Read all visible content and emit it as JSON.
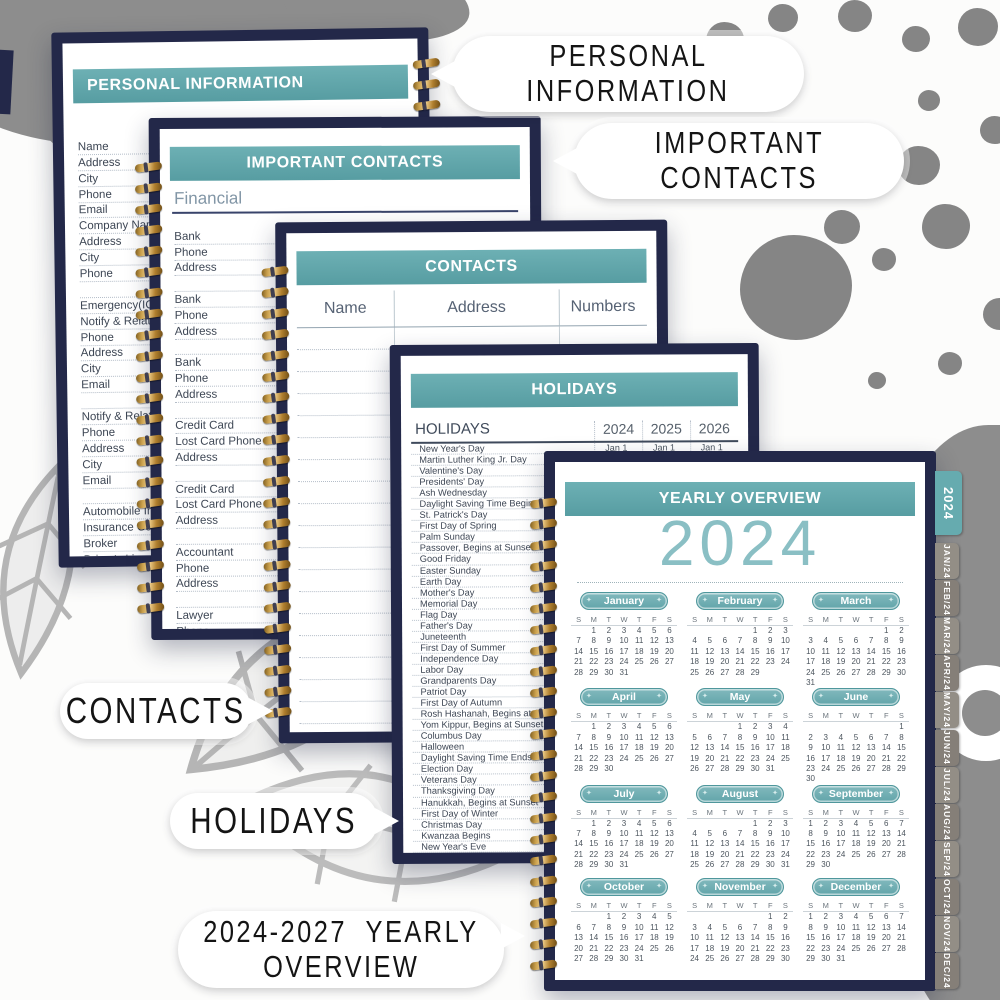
{
  "callouts": {
    "personal_info": {
      "line1": "PERSONAL",
      "line2": "INFORMATION"
    },
    "important_contacts": {
      "line1": "IMPORTANT",
      "line2": "CONTACTS"
    },
    "contacts": {
      "line1": "CONTACTS",
      "line2": ""
    },
    "holidays": {
      "line1": "HOLIDAYS",
      "line2": ""
    },
    "yearly": {
      "line1": "2024-2027  YEARLY",
      "line2": "OVERVIEW"
    }
  },
  "pages": {
    "personal_info": {
      "title": "PERSONAL INFORMATION",
      "rows": [
        "Name",
        "Address",
        "City",
        "Phone",
        "Email",
        "Company Name",
        "Address",
        "City",
        "Phone",
        "",
        "Emergency(ICE)",
        "Notify & Relationship",
        "Phone",
        "Address",
        "City",
        "Email",
        "",
        "Notify & Relationship",
        "Phone",
        "Address",
        "City",
        "Email",
        "",
        "Automobile Information",
        "Insurance Co.",
        "Broker",
        "Driver's License #",
        "Plate #",
        "",
        ""
      ]
    },
    "important_contacts": {
      "title": "IMPORTANT CONTACTS",
      "section": "Financial",
      "rows": [
        "Bank",
        "Phone",
        "Address",
        "",
        "Bank",
        "Phone",
        "Address",
        "",
        "Bank",
        "Phone",
        "Address",
        "",
        "Credit Card",
        "Lost Card Phone",
        "Address",
        "",
        "Credit Card",
        "Lost Card Phone",
        "Address",
        "",
        "Accountant",
        "Phone",
        "Address",
        "",
        "Lawyer",
        "Phone",
        "Address",
        ""
      ],
      "right_labels": [
        "Contact",
        "Email"
      ]
    },
    "contacts": {
      "title": "CONTACTS",
      "columns": [
        "Name",
        "Address",
        "Numbers"
      ],
      "blank_row_count": 18
    },
    "holidays": {
      "title": "HOLIDAYS",
      "header_col": "HOLIDAYS",
      "year_cols": [
        "2024",
        "2025",
        "2026"
      ],
      "rows": [
        {
          "name": "New Year's Day",
          "dates": [
            "Jan 1",
            "Jan 1",
            "Jan 1"
          ]
        },
        {
          "name": "Martin Luther King Jr. Day",
          "dates": [
            "Jan 15",
            "Jan 20",
            "Jan 19"
          ]
        },
        {
          "name": "Valentine's Day",
          "dates": [
            "Feb 14",
            "Feb14",
            "Feb14"
          ]
        },
        {
          "name": "Presidents' Day",
          "dates": [
            "",
            "",
            ""
          ]
        },
        {
          "name": "Ash Wednesday",
          "dates": [
            "",
            "",
            ""
          ]
        },
        {
          "name": "Daylight Saving Time Begins",
          "dates": [
            "",
            "",
            ""
          ]
        },
        {
          "name": "St. Patrick's Day",
          "dates": [
            "",
            "",
            ""
          ]
        },
        {
          "name": "First Day of Spring",
          "dates": [
            "",
            "",
            ""
          ]
        },
        {
          "name": "Palm Sunday",
          "dates": [
            "",
            "",
            ""
          ]
        },
        {
          "name": "Passover, Begins at Sunset",
          "dates": [
            "",
            "",
            ""
          ]
        },
        {
          "name": "Good Friday",
          "dates": [
            "",
            "",
            ""
          ]
        },
        {
          "name": "Easter Sunday",
          "dates": [
            "",
            "",
            ""
          ]
        },
        {
          "name": "Earth Day",
          "dates": [
            "",
            "",
            ""
          ]
        },
        {
          "name": "Mother's Day",
          "dates": [
            "",
            "",
            ""
          ]
        },
        {
          "name": "Memorial Day",
          "dates": [
            "",
            "",
            ""
          ]
        },
        {
          "name": "Flag Day",
          "dates": [
            "",
            "",
            ""
          ]
        },
        {
          "name": "Father's Day",
          "dates": [
            "",
            "",
            ""
          ]
        },
        {
          "name": "Juneteenth",
          "dates": [
            "",
            "",
            ""
          ]
        },
        {
          "name": "First Day of Summer",
          "dates": [
            "",
            "",
            ""
          ]
        },
        {
          "name": "Independence Day",
          "dates": [
            "",
            "",
            ""
          ]
        },
        {
          "name": "Labor Day",
          "dates": [
            "",
            "",
            ""
          ]
        },
        {
          "name": "Grandparents Day",
          "dates": [
            "",
            "",
            ""
          ]
        },
        {
          "name": "Patriot Day",
          "dates": [
            "",
            "",
            ""
          ]
        },
        {
          "name": "First Day of Autumn",
          "dates": [
            "",
            "",
            ""
          ]
        },
        {
          "name": "Rosh Hashanah, Begins at Sunset",
          "dates": [
            "",
            "",
            ""
          ]
        },
        {
          "name": "Yom Kippur, Begins at Sunset",
          "dates": [
            "",
            "",
            ""
          ]
        },
        {
          "name": "Columbus Day",
          "dates": [
            "",
            "",
            ""
          ]
        },
        {
          "name": "Halloween",
          "dates": [
            "",
            "",
            ""
          ]
        },
        {
          "name": "Daylight Saving Time Ends",
          "dates": [
            "",
            "",
            ""
          ]
        },
        {
          "name": "Election Day",
          "dates": [
            "",
            "",
            ""
          ]
        },
        {
          "name": "Veterans Day",
          "dates": [
            "",
            "",
            ""
          ]
        },
        {
          "name": "Thanksgiving Day",
          "dates": [
            "",
            "",
            ""
          ]
        },
        {
          "name": "Hanukkah, Begins at Sunset",
          "dates": [
            "",
            "",
            ""
          ]
        },
        {
          "name": "First Day of Winter",
          "dates": [
            "",
            "",
            ""
          ]
        },
        {
          "name": "Christmas Day",
          "dates": [
            "",
            "",
            ""
          ]
        },
        {
          "name": "Kwanzaa Begins",
          "dates": [
            "",
            "",
            ""
          ]
        },
        {
          "name": "New Year's Eve",
          "dates": [
            "",
            "",
            ""
          ]
        }
      ]
    },
    "yearly": {
      "title": "YEARLY OVERVIEW",
      "year": "2024",
      "dow": [
        "S",
        "M",
        "T",
        "W",
        "T",
        "F",
        "S"
      ],
      "months": [
        {
          "name": "January",
          "weeks": [
            [
              "",
              "1",
              "2",
              "3",
              "4",
              "5",
              "6"
            ],
            [
              "7",
              "8",
              "9",
              "10",
              "11",
              "12",
              "13"
            ],
            [
              "14",
              "15",
              "16",
              "17",
              "18",
              "19",
              "20"
            ],
            [
              "21",
              "22",
              "23",
              "24",
              "25",
              "26",
              "27"
            ],
            [
              "28",
              "29",
              "30",
              "31",
              "",
              "",
              ""
            ]
          ]
        },
        {
          "name": "February",
          "weeks": [
            [
              "",
              "",
              "",
              "",
              "1",
              "2",
              "3"
            ],
            [
              "4",
              "5",
              "6",
              "7",
              "8",
              "9",
              "10"
            ],
            [
              "11",
              "12",
              "13",
              "14",
              "15",
              "16",
              "17"
            ],
            [
              "18",
              "19",
              "20",
              "21",
              "22",
              "23",
              "24"
            ],
            [
              "25",
              "26",
              "27",
              "28",
              "29",
              "",
              ""
            ]
          ]
        },
        {
          "name": "March",
          "weeks": [
            [
              "",
              "",
              "",
              "",
              "",
              "1",
              "2"
            ],
            [
              "3",
              "4",
              "5",
              "6",
              "7",
              "8",
              "9"
            ],
            [
              "10",
              "11",
              "12",
              "13",
              "14",
              "15",
              "16"
            ],
            [
              "17",
              "18",
              "19",
              "20",
              "21",
              "22",
              "23"
            ],
            [
              "24",
              "25",
              "26",
              "27",
              "28",
              "29",
              "30"
            ],
            [
              "31",
              "",
              "",
              "",
              "",
              "",
              ""
            ]
          ]
        },
        {
          "name": "April",
          "weeks": [
            [
              "",
              "1",
              "2",
              "3",
              "4",
              "5",
              "6"
            ],
            [
              "7",
              "8",
              "9",
              "10",
              "11",
              "12",
              "13"
            ],
            [
              "14",
              "15",
              "16",
              "17",
              "18",
              "19",
              "20"
            ],
            [
              "21",
              "22",
              "23",
              "24",
              "25",
              "26",
              "27"
            ],
            [
              "28",
              "29",
              "30",
              "",
              "",
              "",
              ""
            ]
          ]
        },
        {
          "name": "May",
          "weeks": [
            [
              "",
              "",
              "",
              "1",
              "2",
              "3",
              "4"
            ],
            [
              "5",
              "6",
              "7",
              "8",
              "9",
              "10",
              "11"
            ],
            [
              "12",
              "13",
              "14",
              "15",
              "16",
              "17",
              "18"
            ],
            [
              "19",
              "20",
              "21",
              "22",
              "23",
              "24",
              "25"
            ],
            [
              "26",
              "27",
              "28",
              "29",
              "30",
              "31",
              ""
            ]
          ]
        },
        {
          "name": "June",
          "weeks": [
            [
              "",
              "",
              "",
              "",
              "",
              "",
              "1"
            ],
            [
              "2",
              "3",
              "4",
              "5",
              "6",
              "7",
              "8"
            ],
            [
              "9",
              "10",
              "11",
              "12",
              "13",
              "14",
              "15"
            ],
            [
              "16",
              "17",
              "18",
              "19",
              "20",
              "21",
              "22"
            ],
            [
              "23",
              "24",
              "25",
              "26",
              "27",
              "28",
              "29"
            ],
            [
              "30",
              "",
              "",
              "",
              "",
              "",
              ""
            ]
          ]
        },
        {
          "name": "July",
          "weeks": [
            [
              "",
              "1",
              "2",
              "3",
              "4",
              "5",
              "6"
            ],
            [
              "7",
              "8",
              "9",
              "10",
              "11",
              "12",
              "13"
            ],
            [
              "14",
              "15",
              "16",
              "17",
              "18",
              "19",
              "20"
            ],
            [
              "21",
              "22",
              "23",
              "24",
              "25",
              "26",
              "27"
            ],
            [
              "28",
              "29",
              "30",
              "31",
              "",
              "",
              ""
            ]
          ]
        },
        {
          "name": "August",
          "weeks": [
            [
              "",
              "",
              "",
              "",
              "1",
              "2",
              "3"
            ],
            [
              "4",
              "5",
              "6",
              "7",
              "8",
              "9",
              "10"
            ],
            [
              "11",
              "12",
              "13",
              "14",
              "15",
              "16",
              "17"
            ],
            [
              "18",
              "19",
              "20",
              "21",
              "22",
              "23",
              "24"
            ],
            [
              "25",
              "26",
              "27",
              "28",
              "29",
              "30",
              "31"
            ]
          ]
        },
        {
          "name": "September",
          "weeks": [
            [
              "1",
              "2",
              "3",
              "4",
              "5",
              "6",
              "7"
            ],
            [
              "8",
              "9",
              "10",
              "11",
              "12",
              "13",
              "14"
            ],
            [
              "15",
              "16",
              "17",
              "18",
              "19",
              "20",
              "21"
            ],
            [
              "22",
              "23",
              "24",
              "25",
              "26",
              "27",
              "28"
            ],
            [
              "29",
              "30",
              "",
              "",
              "",
              "",
              ""
            ]
          ]
        },
        {
          "name": "October",
          "weeks": [
            [
              "",
              "",
              "1",
              "2",
              "3",
              "4",
              "5"
            ],
            [
              "6",
              "7",
              "8",
              "9",
              "10",
              "11",
              "12"
            ],
            [
              "13",
              "14",
              "15",
              "16",
              "17",
              "18",
              "19"
            ],
            [
              "20",
              "21",
              "22",
              "23",
              "24",
              "25",
              "26"
            ],
            [
              "27",
              "28",
              "29",
              "30",
              "31",
              "",
              ""
            ]
          ]
        },
        {
          "name": "November",
          "weeks": [
            [
              "",
              "",
              "",
              "",
              "",
              "1",
              "2"
            ],
            [
              "3",
              "4",
              "5",
              "6",
              "7",
              "8",
              "9"
            ],
            [
              "10",
              "11",
              "12",
              "13",
              "14",
              "15",
              "16"
            ],
            [
              "17",
              "18",
              "19",
              "20",
              "21",
              "22",
              "23"
            ],
            [
              "24",
              "25",
              "26",
              "27",
              "28",
              "29",
              "30"
            ]
          ]
        },
        {
          "name": "December",
          "weeks": [
            [
              "1",
              "2",
              "3",
              "4",
              "5",
              "6",
              "7"
            ],
            [
              "8",
              "9",
              "10",
              "11",
              "12",
              "13",
              "14"
            ],
            [
              "15",
              "16",
              "17",
              "18",
              "19",
              "20",
              "21"
            ],
            [
              "22",
              "23",
              "24",
              "25",
              "26",
              "27",
              "28"
            ],
            [
              "29",
              "30",
              "31",
              "",
              "",
              "",
              ""
            ]
          ]
        }
      ]
    }
  },
  "tabs": {
    "year_tab": "2024",
    "month_tabs": [
      "JAN/24",
      "FEB/24",
      "MAR/24",
      "APR/24",
      "MAY/24",
      "JUN/24",
      "JUL/24",
      "AUG/24",
      "SEP/24",
      "OCT/24",
      "NOV/24",
      "DEC/24"
    ]
  },
  "colors": {
    "teal_header": "#60a8ac",
    "navy_cover": "#232849",
    "big_year_text": "#8abfc4",
    "tab_gray_a": "#938e86",
    "tab_gray_b": "#857f78",
    "coil_gold": "#caa04c"
  }
}
